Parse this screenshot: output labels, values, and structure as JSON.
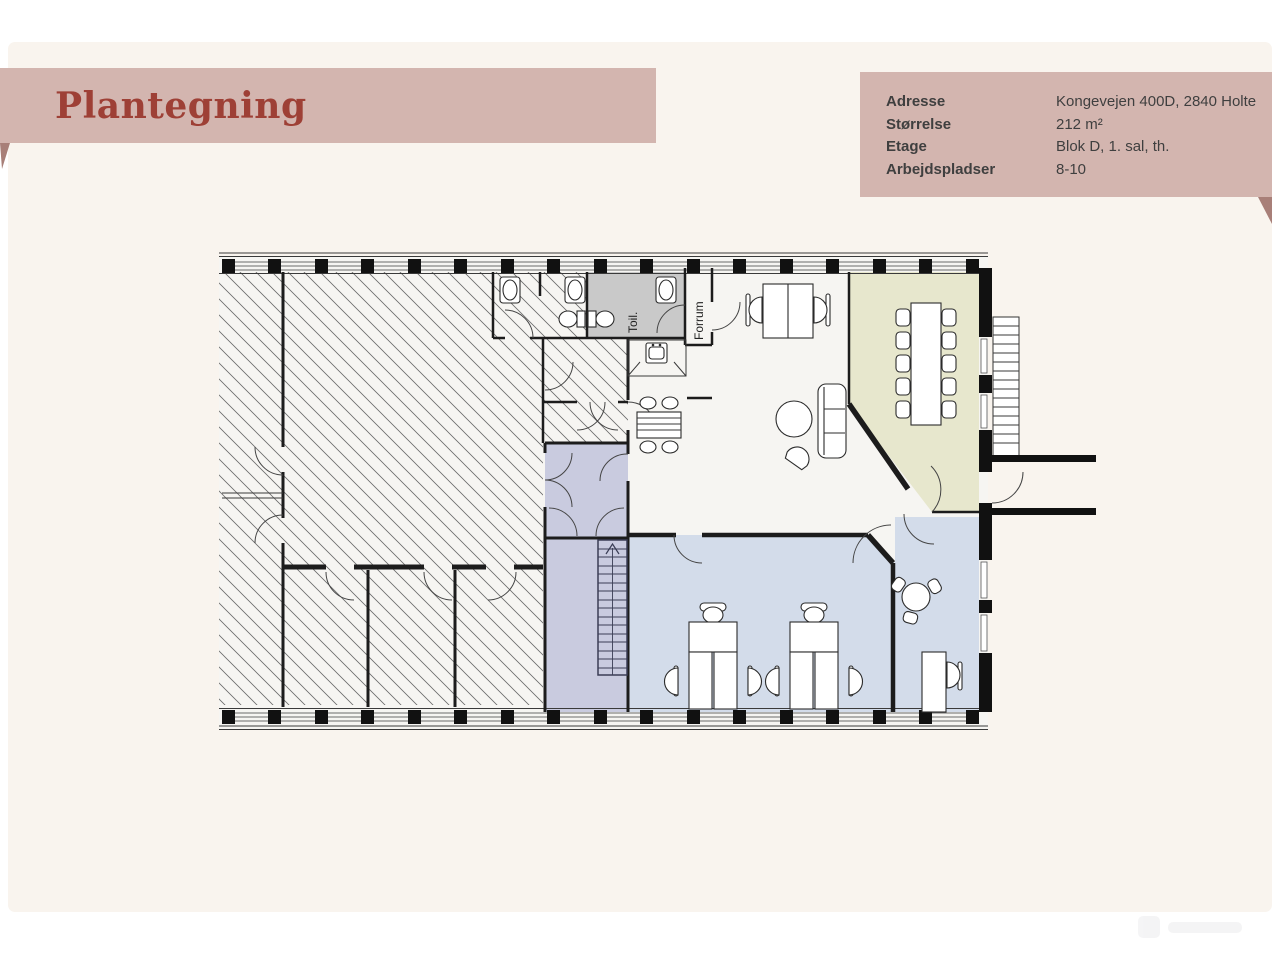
{
  "page": {
    "background": "#ffffff",
    "card_background": "#f9f4ee"
  },
  "header": {
    "title": "Plantegning",
    "banner_color": "#d3b5af",
    "fold_color": "#a87f78",
    "title_color": "#9e4036"
  },
  "info_panel": {
    "background": "#d3b5af",
    "text_color": "#3f3f3f",
    "rows": [
      {
        "label": "Adresse",
        "value": "Kongevejen 400D, 2840 Holte"
      },
      {
        "label": "Størrelse",
        "value": "212 m²"
      },
      {
        "label": "Etage",
        "value": "Blok D, 1. sal, th."
      },
      {
        "label": "Arbejdspladser",
        "value": "8-10"
      }
    ]
  },
  "floorplan": {
    "labels": [
      {
        "text": "Toil."
      },
      {
        "text": "Forrum"
      }
    ],
    "colors": {
      "wall": "#1c1c1c",
      "hatch_line": "#6b6b6b",
      "toilet_room_gray": "#c9c9c9",
      "meeting_room_olive": "#e7e7cd",
      "stair_hall_lavender": "#c9cbdf",
      "open_office_blue": "#d3dcea",
      "interior_white": "#f6f5f2"
    }
  }
}
